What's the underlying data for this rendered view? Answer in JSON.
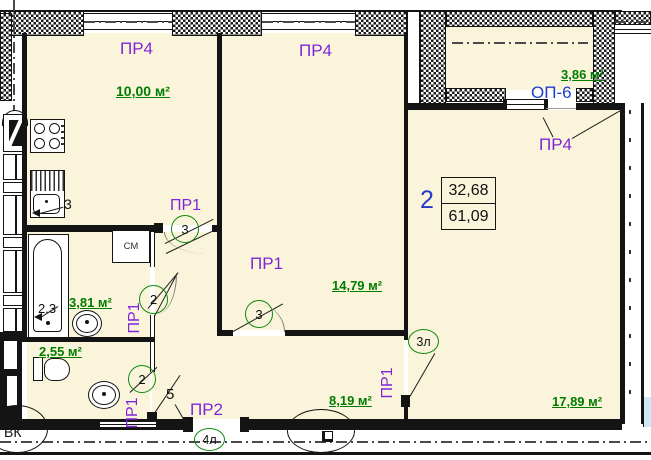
{
  "plan": {
    "stamp": {
      "number": "2",
      "upper_area": "32,68",
      "lower_area": "61,09"
    },
    "rooms": {
      "kitchen": {
        "opening_label": "ПР4",
        "area": "10,00 м²",
        "equip_mark": "3"
      },
      "bedroom": {
        "opening_label": "ПР4",
        "door_label": "ПР1",
        "area": "14,79 м²",
        "door_mark": "3"
      },
      "living": {
        "area": "17,89 м²",
        "door_label": "ПР1",
        "door_mark": "3л",
        "balcony_door_label": "ПР4"
      },
      "balcony": {
        "code": "ОП-6",
        "area": "3,86 м²"
      },
      "bathroom": {
        "area": "3,81 м²",
        "tub_dim": "2.3",
        "washer_label": "СМ",
        "door_label": "ПР1",
        "door_mark": "2"
      },
      "wc": {
        "area": "2,55 м²",
        "door_label": "ПР1",
        "door_mark": "2"
      },
      "hall": {
        "area": "8,19 м²",
        "kitchen_door_label": "ПР1",
        "kitchen_door_mark": "3",
        "partition_mark": "5",
        "entrance_door_label": "ПР2",
        "entrance_door_mark": "4л"
      }
    },
    "marks": {
      "vk": "ВК"
    },
    "colors": {
      "room_fill": "#faf5da",
      "area_text": "#007d00",
      "opening_label": "#8026d9",
      "stamp_number": "#2438cc",
      "circle_stroke": "#0e8a0e"
    }
  }
}
